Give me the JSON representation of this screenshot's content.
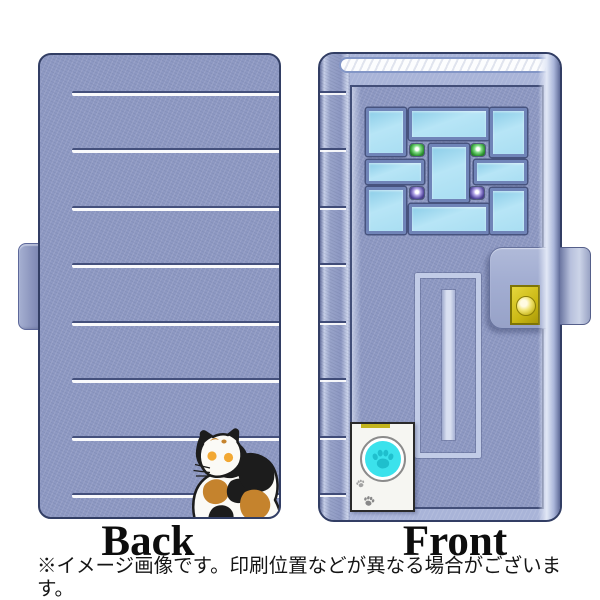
{
  "product_view": {
    "back_label": "Back",
    "front_label": "Front"
  },
  "disclaimer": {
    "line1": "※イメージ画像です。印刷位置などが異なる場合がございます。",
    "line2": "※Back側には機種に応じてカメラ等の穴があきます。"
  },
  "colors": {
    "case-base": "#8e99c3",
    "case-edge": "#aab5d8",
    "case-outline": "#323e64",
    "stripe-white": "#ffffff",
    "stripe-shadow": "#404c78",
    "window-pane": "#a9def2",
    "window-frame": "#7084b8",
    "led-green": "#2f9633",
    "led-purple": "#554a9e",
    "clasp-yellow": "#d6c41f",
    "doorbell-cyan": "#3be2ec",
    "paw-on-button": "#1fbfcd",
    "cat-orange": "#c5832d",
    "cat-black": "#1c1c1c",
    "cat-white": "#fbfaf6",
    "cat-eye": "#f2a833"
  }
}
